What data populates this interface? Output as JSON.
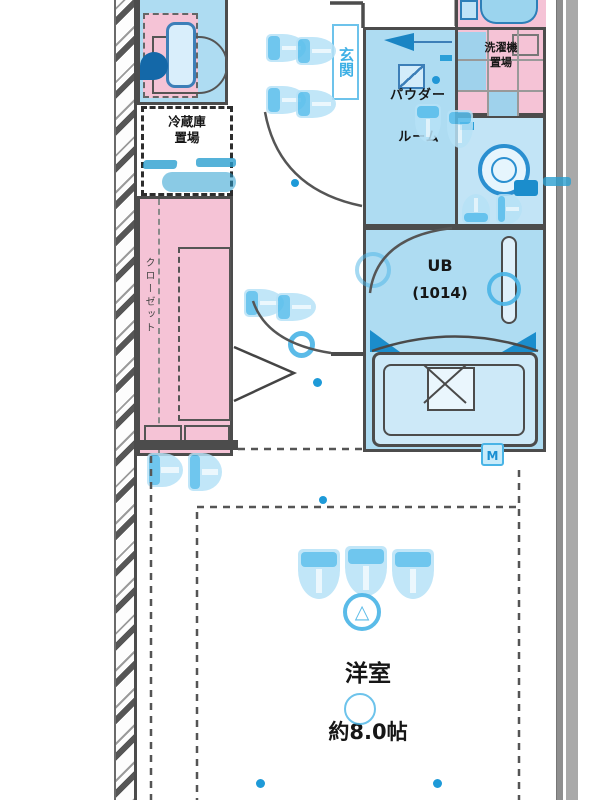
{
  "colors": {
    "room_blue": "#aedcf2",
    "pink": "#f5c3d6",
    "wall_gray": "#4c4c4c",
    "fixture_blue": "#2a8fd0",
    "dark_blue": "#1a85c4",
    "watermark_blue": "#49b4e6"
  },
  "labels": {
    "fridge": {
      "line1": "冷蔵庫",
      "line2": "置場"
    },
    "ps": "PS",
    "closet": "クローゼット",
    "entrance": "玄関",
    "powder": {
      "line1": "パウダー",
      "line2": "ルーム"
    },
    "washer": {
      "line1": "洗濯機",
      "line2": "置場"
    },
    "unit_bath": {
      "line1": "UB",
      "line2": "(1014)"
    },
    "room": {
      "name": "洋室",
      "size": "約8.0帖"
    },
    "outlet_badge": "M"
  }
}
